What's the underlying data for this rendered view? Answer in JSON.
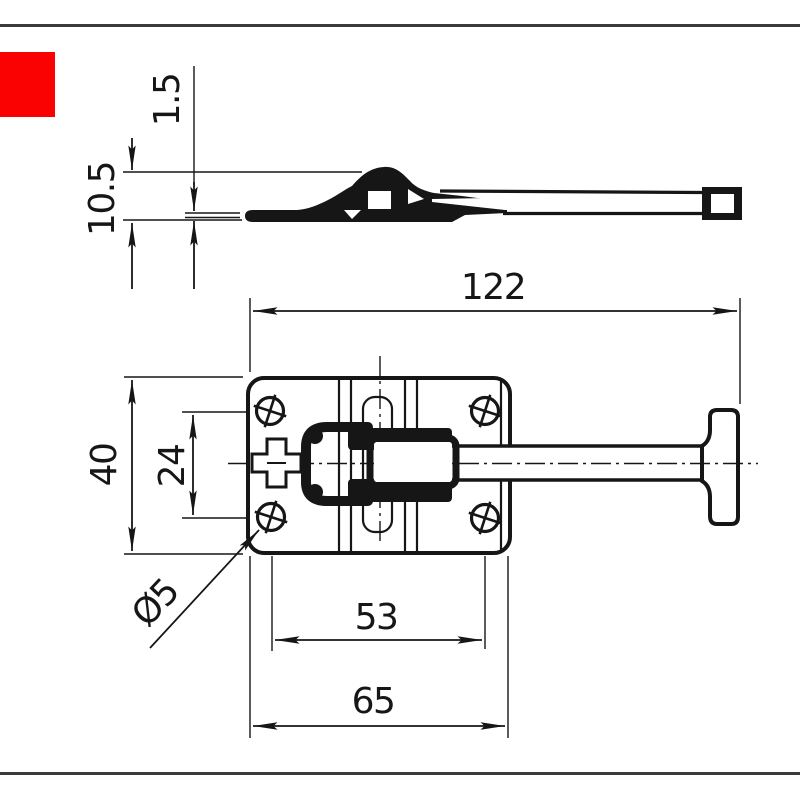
{
  "page": {
    "background": "#ffffff",
    "frame_line_color": "#3b3b3b",
    "ink_color": "#161616",
    "accent_square_color": "#fa0202"
  },
  "drawing": {
    "part_name": "spring door retainer latch with T-handle",
    "views": {
      "top": "side profile view",
      "main": "plan view with mounting plate and T-handle arm"
    },
    "dimensions": {
      "overall_length": "122",
      "plate_height": "40",
      "hole_spacing_vertical": "24",
      "hole_spacing_horizontal": "53",
      "plate_width": "65",
      "hole_diameter": "Ø5",
      "material_thickness": "1.5",
      "profile_height": "10.5"
    }
  }
}
